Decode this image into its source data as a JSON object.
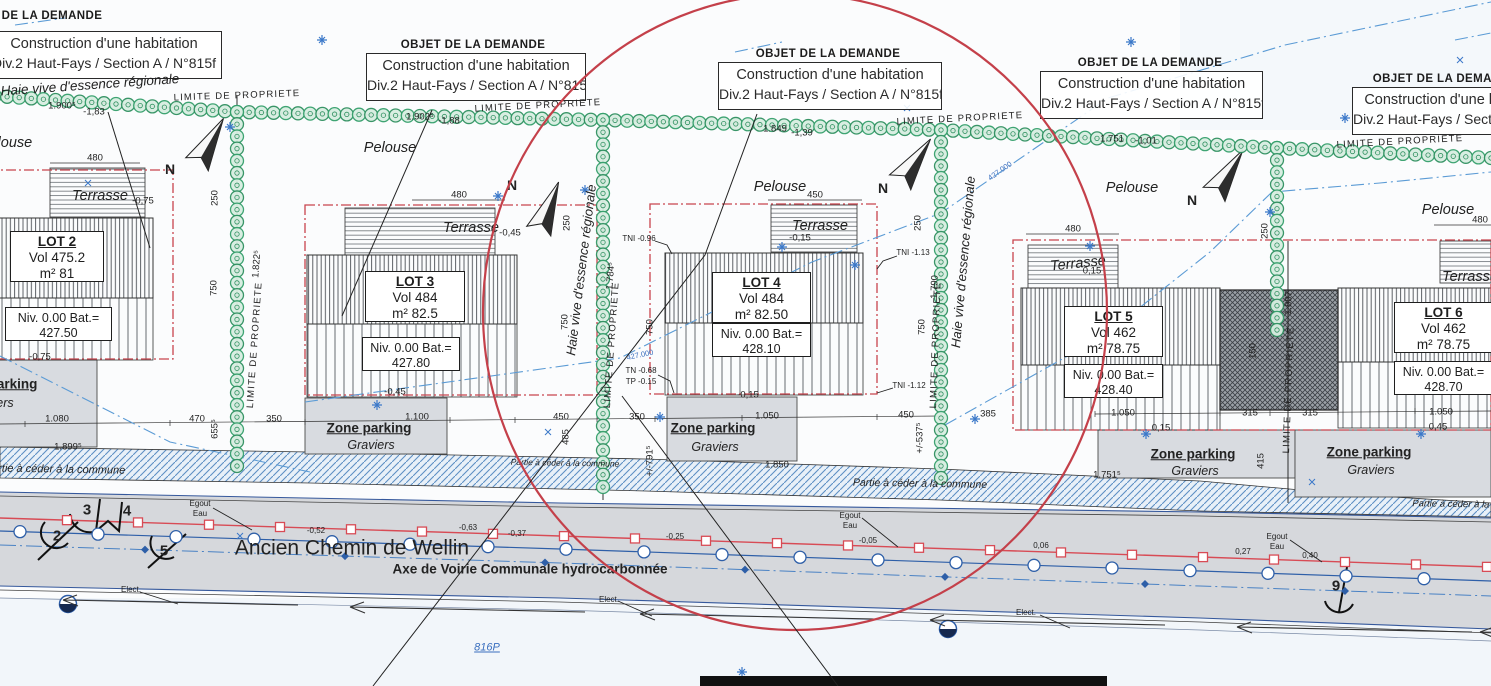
{
  "objet": {
    "title": "OBJET DE LA DEMANDE",
    "line1": "Construction d'une habitation",
    "line2": "Div.2 Haut-Fays / Section A  / N°815f"
  },
  "lots": [
    {
      "name": "LOT 2",
      "vol": "Vol 475.2",
      "surface": "m² 81",
      "niv_label": "Niv. 0.00 Bat.=",
      "niv_value": "427.50"
    },
    {
      "name": "LOT 3",
      "vol": "Vol 484",
      "surface": "m² 82.5",
      "niv_label": "Niv. 0.00 Bat.=",
      "niv_value": "427.80"
    },
    {
      "name": "LOT 4",
      "vol": "Vol 484",
      "surface": "m² 82.50",
      "niv_label": "Niv. 0.00 Bat.=",
      "niv_value": "428.10"
    },
    {
      "name": "LOT 5",
      "vol": "Vol 462",
      "surface": "m² 78.75",
      "niv_label": "Niv. 0.00 Bat.=",
      "niv_value": "428.40"
    },
    {
      "name": "LOT 6",
      "vol": "Vol 462",
      "surface": "m² 78.75",
      "niv_label": "Niv. 0.00 Bat.=",
      "niv_value": "428.70"
    }
  ],
  "labels": {
    "haie": "Haie vive d'essence régionale",
    "limite": "LIMITE DE PROPRIETE",
    "pelouse": "Pelouse",
    "terrasse": "Terrasse",
    "zone_parking": "Zone parking",
    "graviers": "Graviers",
    "partie": "Partie à céder à la commune",
    "road_name": "Ancien Chemin de Wellin",
    "road_axis": "Axe de Voirie Communale hydrocarbonnée",
    "parcel_ref": "816P",
    "egout": "Egout",
    "eau": "Eau",
    "elect": "Elect.",
    "north": "N"
  },
  "dimensions": [
    "1.900⁵",
    "-1,83",
    "1.902⁵",
    "-1,88",
    "1.849",
    "-1,39",
    "1.751",
    "-1,01",
    "480",
    "250",
    "750",
    "1.822⁵",
    "-0,75",
    "-0,75",
    "470",
    "655⁵",
    "350",
    "1.080",
    "1.899⁵",
    "480",
    "250",
    "750",
    "1.784⁵",
    "-0,45",
    "-0,45",
    "1.100",
    "450",
    "485",
    "450",
    "250",
    "750",
    "750",
    "1.790",
    "-0,15",
    "-0,15",
    "350",
    "1.050",
    "450",
    "385",
    "1.850",
    "+/-791⁵",
    "+/-537⁵",
    "480",
    "0,15",
    "1.050",
    "0,15",
    "315",
    "315",
    "1.050",
    "0,45",
    "415",
    "1.751⁵",
    "150",
    "250",
    "480",
    "1.807",
    "427.000",
    "427.000"
  ],
  "road_values": [
    "-0,63",
    "-0,52",
    "-0,37",
    "-0,25",
    "-0,05",
    "0,06",
    "0,27",
    "0,40"
  ],
  "levels": [
    "TNI -0.96",
    "TNI -1.13",
    "TNI -1.12",
    "TN -0.68",
    "TP -0.15"
  ],
  "point_numbers": [
    "2",
    "3",
    "4",
    "5",
    "9"
  ],
  "colors": {
    "hedge_green": "#2f9060",
    "hedge_fill": "#d8eee1",
    "limit_red": "#c8444e",
    "stamp_red": "#c4404a",
    "water_blue": "#2e5fa8",
    "egout_red": "#d84b55",
    "dash_blue": "#5b9bd5",
    "road_gray": "#d6d8dc",
    "parking_gray": "#d8dbe0"
  }
}
